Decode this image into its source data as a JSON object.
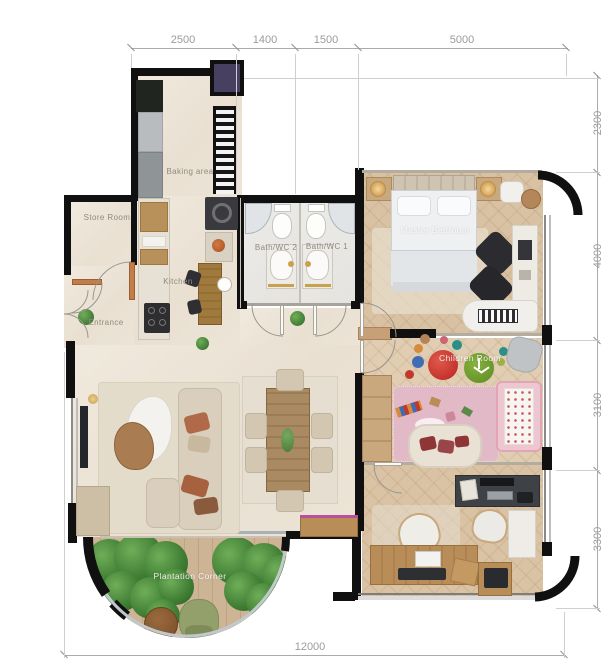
{
  "plan": {
    "dimensions": {
      "top": [
        "2500",
        "1400",
        "1500",
        "5000"
      ],
      "right": [
        "2300",
        "4000",
        "3100",
        "3300"
      ],
      "bottom": [
        "12000"
      ]
    },
    "rooms": {
      "store_room": "Store Room",
      "entrance": "Entrance",
      "baking_area": "Baking area",
      "kitchen": "Kitchen",
      "bath_wc_2": "Bath/WC 2",
      "bath_wc_1": "Bath/WC 1",
      "master_bedroom": "Master Bedroom",
      "children_room": "Children Room",
      "plantation_corner": "Plantation Corner"
    },
    "colors": {
      "wall": "#101010",
      "floor_cream": "#ede5d8",
      "floor_wood": "#d8c2a3",
      "floor_bath": "#e9e7e3",
      "balcony_deck": "#c9ae8d",
      "plant_green": "#4c8a3f",
      "accent_pink": "#e2b9c6",
      "dimension_text": "#9b9b9b",
      "label_text": "#8f8a80"
    }
  }
}
